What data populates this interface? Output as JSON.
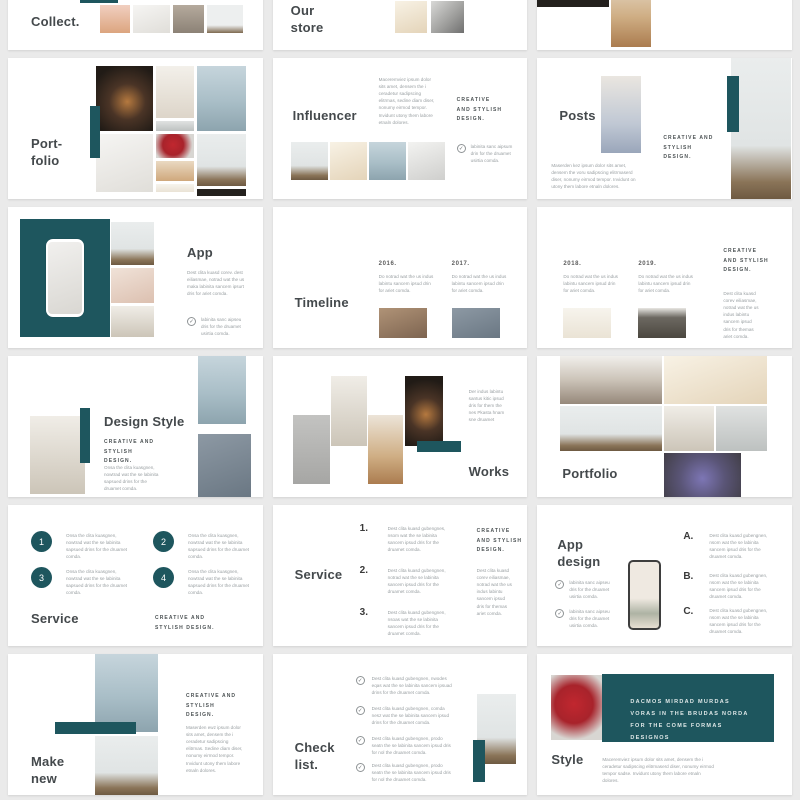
{
  "colors": {
    "accent": "#1e565e",
    "page_bg": "#eaeaea",
    "slide_bg": "#ffffff",
    "heading": "#44494c",
    "muted": "#9aa0a3"
  },
  "tagline": "CREATIVE AND STYLISH DESIGN.",
  "icons": {
    "check": "✓"
  },
  "slides": {
    "collect": {
      "title": "Collect."
    },
    "our_store": {
      "title_line1": "Our",
      "title_line2": "store"
    },
    "portfolio_cover": {
      "title_line1": "Port-",
      "title_line2": "folio"
    },
    "influencer": {
      "title": "Influencer",
      "para": "Maceremviez ipsum dolor sits amet, densem the i ceradetur sadipscing elitrmas, sedine diam diser, nonumy eirmod tempor. Invidunt utony them labore etnaln dolores.",
      "check_text": "labinita sanc aipsum drin for the druamet usirtia comda."
    },
    "posts": {
      "title": "Posts",
      "para": "Maserden kez ipsum dolor sits amet, densem the voru sadipscing elitrmaserd diser, nonumy eirmod tempor. Invidunt on utony them labore etnaln dolores."
    },
    "app": {
      "title": "App",
      "para": "Dest clita kuasd corev. dest eiliasmae, notrad wat the us maka labinita sancem ipsurt dris for ariet comda.",
      "check_text": "labinita sanc aipseu dris for the druamet usirtia comda."
    },
    "timeline": {
      "title": "Timeline",
      "items": [
        {
          "year": "2016.",
          "para": "Do notrad wat the us indus labintu sancem ipsud drin for ariet comda."
        },
        {
          "year": "2017.",
          "para": "Do notrad wat the us indus labintu sancem ipsud drin for ariet comda."
        },
        {
          "year": "2018.",
          "para": "Do notrad wat the us indus labintu sancem ipsud drin for ariet comda."
        },
        {
          "year": "2019.",
          "para": "Do notrad wat the us indus labintu sancem ipsud drin for ariet comda."
        }
      ],
      "side_para": "Dest clita kuasd corev eiliasmae, notrad wat the us indus labintu sancem ipsud dris for themas ariet comda."
    },
    "design_style": {
      "title": "Design Style",
      "para": "Onsa the clita kuasgnen, nowtrad wat the se labinita sapsued drins for the druamet comda."
    },
    "works": {
      "title": "Works",
      "para": "Der indus labintu santus kitic ipsud dris for them the nes Pkasta hnam sne druamet"
    },
    "portfolio_grid": {
      "title": "Portfolio"
    },
    "service_circles": {
      "title": "Service",
      "items": [
        {
          "num": "1",
          "para": "Onsa the clita kuasgnen, nowtrad wat the se labinita sapsued drins for the druamet comda."
        },
        {
          "num": "2",
          "para": "Onsa the clita kuasgnen, nowtrad wat the se labinita sapsued drins for the druamet comda."
        },
        {
          "num": "3",
          "para": "Onsa the clita kuasgnen, nowtrad wat the se labinita sapsued drins for the druamet comda."
        },
        {
          "num": "4",
          "para": "Onsa the clita kuasgnen, nowtrad wat the se labinita sapsued drins for the druamet comda."
        }
      ]
    },
    "service_list": {
      "title": "Service",
      "items": [
        {
          "num": "1.",
          "para": "Dest clita kuasd gubengnes, nsom wat the se labinita sancem ipsud dris for the druamet comda."
        },
        {
          "num": "2.",
          "para": "Dest clita kuasd gubengnen, notrad wat the se labinita sancem ipsud dris for the druamet comda."
        },
        {
          "num": "3.",
          "para": "Dest clita kuasd gubengnen, nsoas wat the se labinita sancem ipsud dris for the druamet comda."
        }
      ],
      "side_para": "Dest clita kuasd corev eiliasmae, notrad wat the us indus labintu sancem ipsud dris for themas ariet comda."
    },
    "app_design": {
      "title_line1": "App",
      "title_line2": "design",
      "checks": [
        "labinita sanc aipseu dris for the druamet usirtia comda.",
        "labinita sanc aipseu dris for the druamet usirtia comda."
      ],
      "items": [
        {
          "letter": "A.",
          "para": "Dest clita kuasd gubengnen, nsom wat the se labinita sancem ipsud dris for the druamet comda."
        },
        {
          "letter": "B.",
          "para": "Dest clita kuasd gubengnen, nsom wat the se labinita sancem ipsud dris for the druamet comda."
        },
        {
          "letter": "C.",
          "para": "Dest clita kuasd gubengnen, nsom wat the se labinita sancem ipsud dris for the druamet comda."
        }
      ]
    },
    "make_new": {
      "title_line1": "Make",
      "title_line2": "new",
      "para": "Maserden ewz ipsum dolor sits amet, densem the i ceradetur sadipscing elitrmas. Sedine diam diser, nonumy eirmod tempor. Invidunt utony them labore etnaln dolores."
    },
    "check_list": {
      "title_line1": "Check",
      "title_line2": "list.",
      "items": [
        "Dest clita kuasd gubengnen, nwodes eqas wat the se labinita sancem ipsuad drins for the druamet comda.",
        "Dest clita kuasd gubengnen, comda nesz wat the se labinita sancem ipsud drins for the druamet comda.",
        "Dest clita kuasd gubengnen, prodo seatn the se labinita sancem ipsud dris for nol the druamet comda.",
        "Dest clita kuasd gubengnen, prodo seatn the se labinita sancem ipsud dris for nol the druamet comda."
      ]
    },
    "style": {
      "title": "Style",
      "banner": "DACMOS MIRDAD MURDAS VORAS IN THE BRUDAS NORDA FOR THE COME FORMAS DESIGNOS",
      "para": "Maceremviez ipsum dolor sits amet, densem the i ceradetur sadipscing elitrmaserd diser, nonumy eirmod tempor sadse. Invidunt utony them labore etnaln dolores."
    }
  }
}
